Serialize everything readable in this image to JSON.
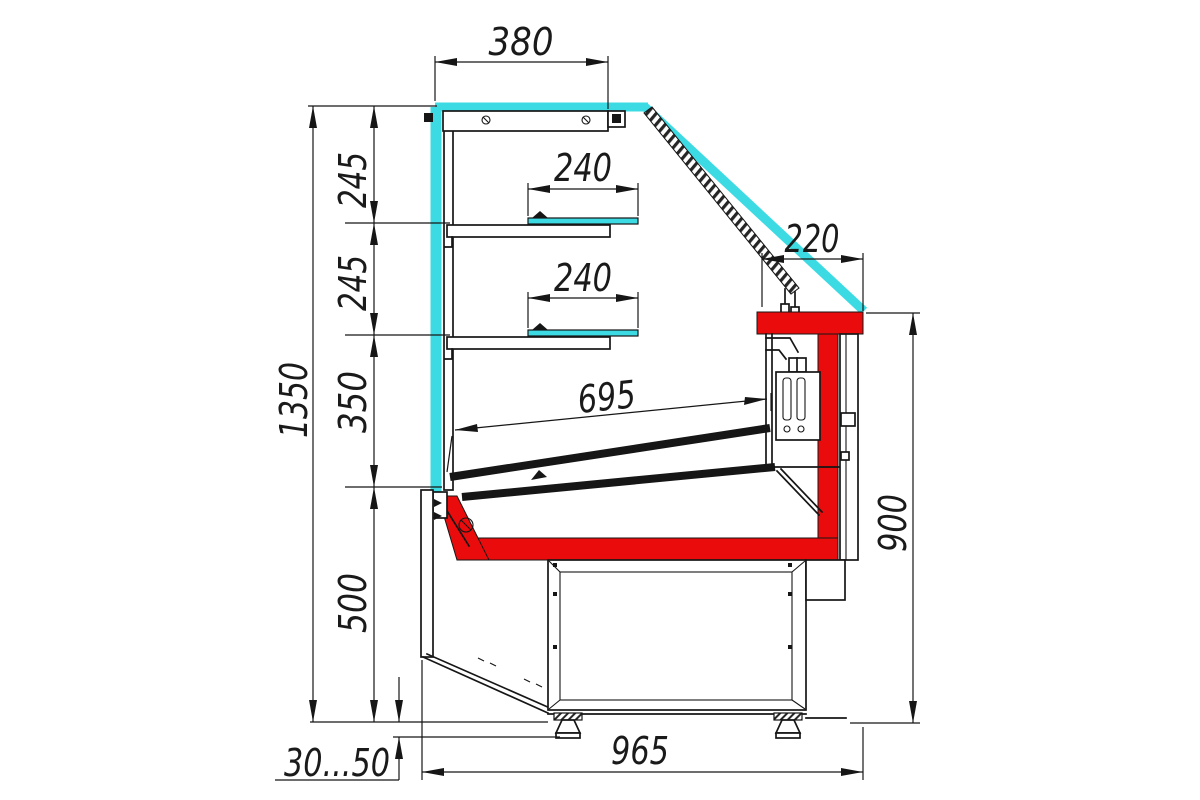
{
  "drawing": {
    "dimensions_mm": {
      "top_depth": "380",
      "upper_shelf_depth": "240",
      "lower_shelf_depth": "240",
      "glass_edge_offset": "220",
      "display_deck_length": "695",
      "overall_height": "1350",
      "shelf_gap_upper": "245",
      "shelf_gap_lower": "245",
      "shelf_to_deck": "350",
      "base_height": "500",
      "service_side_height": "900",
      "base_depth": "965",
      "leg_height_range": "30...50"
    },
    "colors": {
      "glass": "#3cdbe3",
      "accent_red": "#ea0c0c",
      "line": "#161616",
      "background": "#ffffff"
    }
  }
}
